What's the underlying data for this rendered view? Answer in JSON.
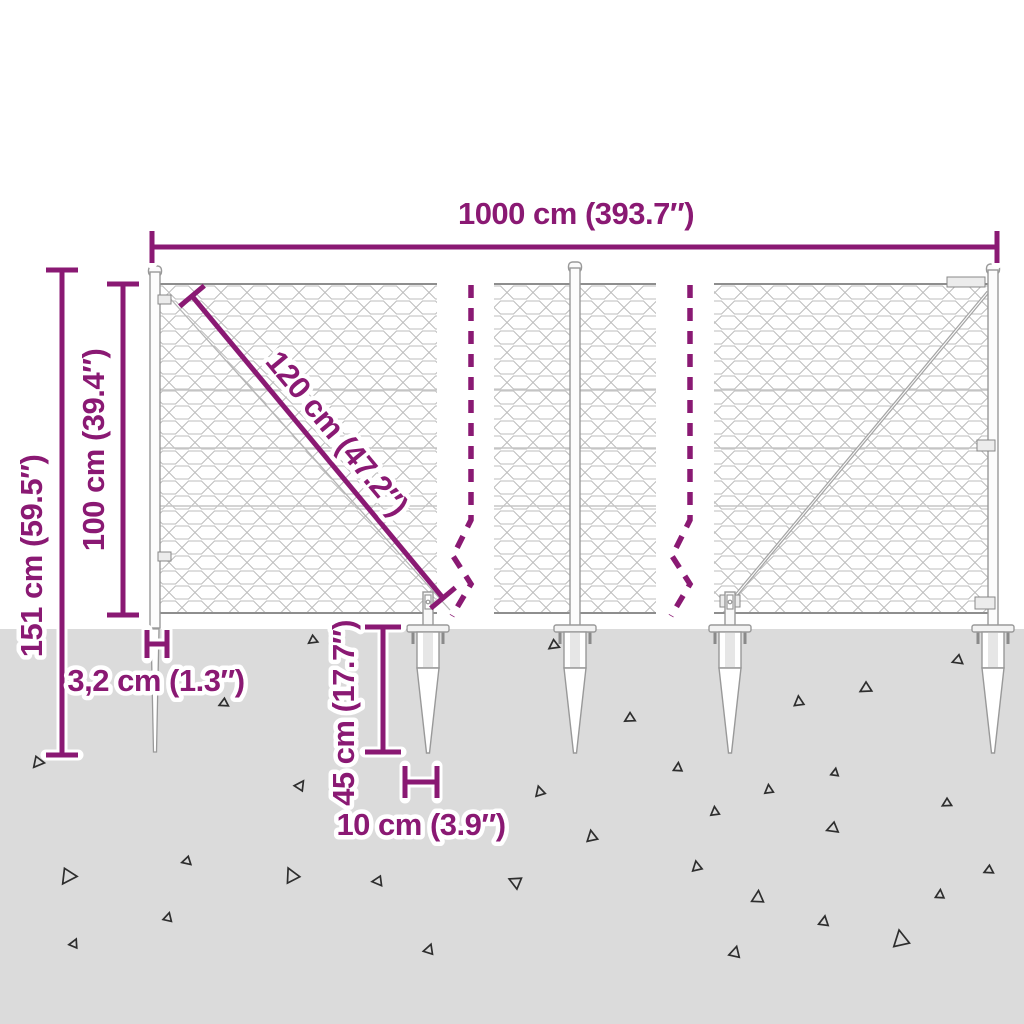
{
  "title": "wire-mesh-fence-with-spike-anchors-dimension-diagram",
  "colors": {
    "dimension_accent": "#8A1973",
    "ground": "#DBDBDB",
    "mesh_wire": "#BCBCBC",
    "mesh_rail": "#8E8E8E",
    "hardware_outline": "#999999",
    "hardware_fill": "#FAFAFA",
    "gravel_triangle": "#2E2E2E"
  },
  "annotations": {
    "total_width": "1000 cm (393.7″)",
    "overall_height": "151 cm (59.5″)",
    "mesh_height": "100 cm (39.4″)",
    "mesh_diagonal": "120 cm (47.2″)",
    "post_width": "3,2 cm (1.3″)",
    "spike_length": "45 cm (17.7″)",
    "spike_plate_width": "10 cm (3.9″)"
  },
  "ground": {
    "triangles": [
      {
        "x": 38,
        "y": 762,
        "s": 1.0,
        "r": -15
      },
      {
        "x": 224,
        "y": 703,
        "s": 0.8,
        "r": 10
      },
      {
        "x": 313,
        "y": 640,
        "s": 0.8,
        "r": 0
      },
      {
        "x": 300,
        "y": 786,
        "s": 0.9,
        "r": 160
      },
      {
        "x": 443,
        "y": 833,
        "s": 0.7,
        "r": 150
      },
      {
        "x": 68,
        "y": 876,
        "s": 1.4,
        "r": -20
      },
      {
        "x": 187,
        "y": 861,
        "s": 0.8,
        "r": 20
      },
      {
        "x": 292,
        "y": 876,
        "s": 1.3,
        "r": 100
      },
      {
        "x": 378,
        "y": 881,
        "s": 0.9,
        "r": 30
      },
      {
        "x": 168,
        "y": 918,
        "s": 0.8,
        "r": 140
      },
      {
        "x": 74,
        "y": 944,
        "s": 0.8,
        "r": 150
      },
      {
        "x": 429,
        "y": 950,
        "s": 0.9,
        "r": 145
      },
      {
        "x": 554,
        "y": 645,
        "s": 0.9,
        "r": 0
      },
      {
        "x": 630,
        "y": 718,
        "s": 0.9,
        "r": 5
      },
      {
        "x": 799,
        "y": 702,
        "s": 0.9,
        "r": 120
      },
      {
        "x": 866,
        "y": 688,
        "s": 1.0,
        "r": 5
      },
      {
        "x": 958,
        "y": 660,
        "s": 0.9,
        "r": 15
      },
      {
        "x": 678,
        "y": 768,
        "s": 0.8,
        "r": 130
      },
      {
        "x": 540,
        "y": 792,
        "s": 0.9,
        "r": 110
      },
      {
        "x": 592,
        "y": 837,
        "s": 1.0,
        "r": 115
      },
      {
        "x": 769,
        "y": 790,
        "s": 0.8,
        "r": 120
      },
      {
        "x": 835,
        "y": 773,
        "s": 0.7,
        "r": 135
      },
      {
        "x": 833,
        "y": 828,
        "s": 1.0,
        "r": 15
      },
      {
        "x": 715,
        "y": 812,
        "s": 0.8,
        "r": 120
      },
      {
        "x": 947,
        "y": 803,
        "s": 0.8,
        "r": 5
      },
      {
        "x": 697,
        "y": 867,
        "s": 0.9,
        "r": 115
      },
      {
        "x": 758,
        "y": 898,
        "s": 1.1,
        "r": 130
      },
      {
        "x": 824,
        "y": 922,
        "s": 0.9,
        "r": 135
      },
      {
        "x": 901,
        "y": 940,
        "s": 1.5,
        "r": 115
      },
      {
        "x": 940,
        "y": 895,
        "s": 0.8,
        "r": 130
      },
      {
        "x": 735,
        "y": 953,
        "s": 1.0,
        "r": 140
      },
      {
        "x": 989,
        "y": 870,
        "s": 0.8,
        "r": 10
      },
      {
        "x": 516,
        "y": 882,
        "s": 1.1,
        "r": 60
      }
    ]
  }
}
